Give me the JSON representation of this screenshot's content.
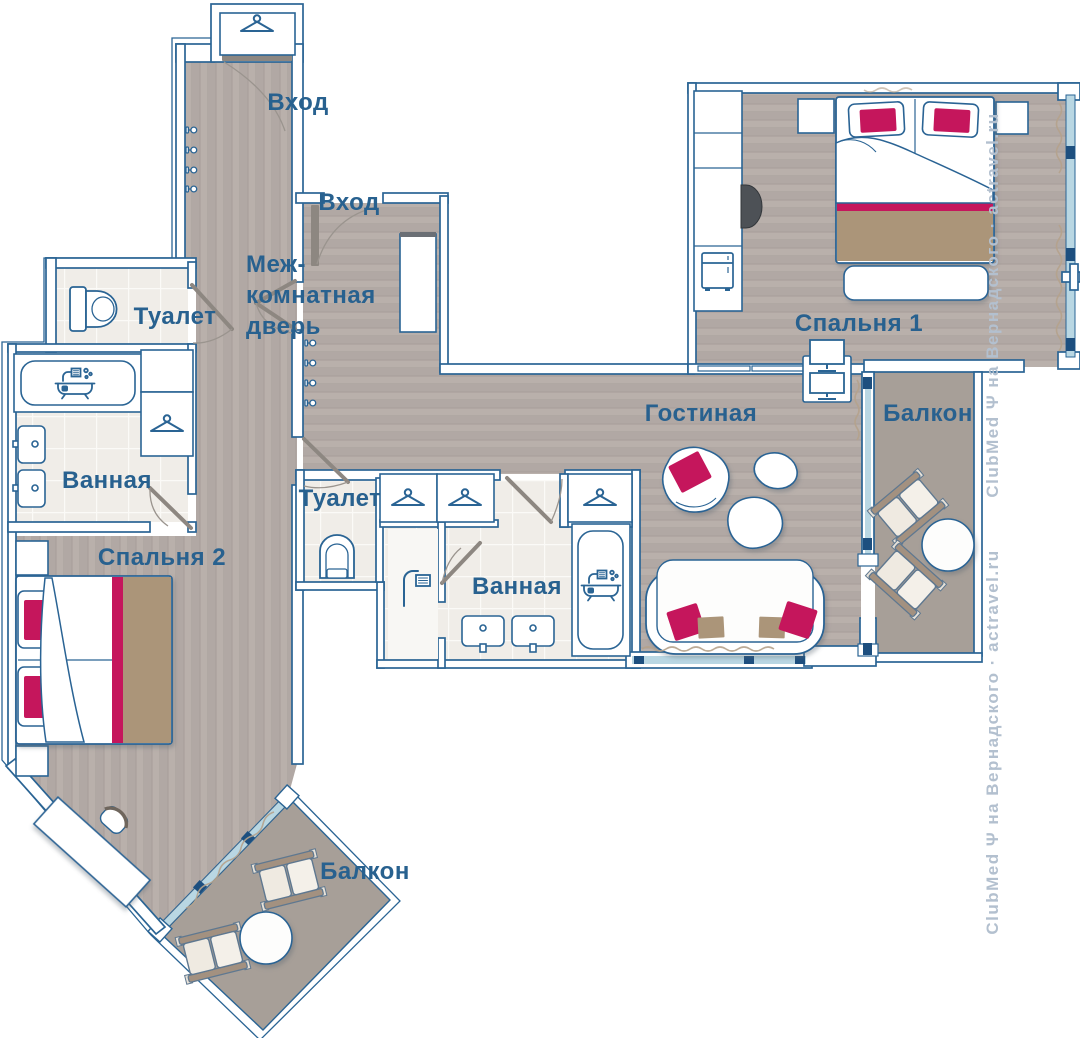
{
  "plan": {
    "labels": {
      "entrance_top": "Вход",
      "entrance_mid": "Вход",
      "interroom_line1": "Меж-",
      "interroom_line2": "комнатная",
      "interroom_line3": "дверь",
      "toilet_left": "Туалет",
      "bathroom_left": "Ванная",
      "bedroom_2": "Спальня 2",
      "toilet_center": "Туалет",
      "bathroom_center": "Ванная",
      "living_room": "Гостиная",
      "bedroom_1": "Спальня 1",
      "balcony_right": "Балкон",
      "balcony_bottom": "Балкон"
    },
    "watermark": "ClubMed Ψ на Вернадского · actravel.ru",
    "colors": {
      "line_blue": "#2a6494",
      "label_text": "#28618f",
      "accent_crimson": "#c5185c",
      "tan": "#ab9579",
      "wood_floor": "#b6ada8",
      "tile_floor": "#f0ede8",
      "balcony_floor": "#a79f98",
      "glass": "#b9d7e3",
      "watermark_color": "#b3c0cf"
    },
    "icons": [
      "hanger-icon",
      "hook-icon",
      "toilet-icon",
      "bathtub-icon",
      "sink-icon",
      "shower-icon",
      "fridge-icon",
      "tv-icon",
      "monitor-icon",
      "lounge-chair",
      "round-table"
    ]
  }
}
